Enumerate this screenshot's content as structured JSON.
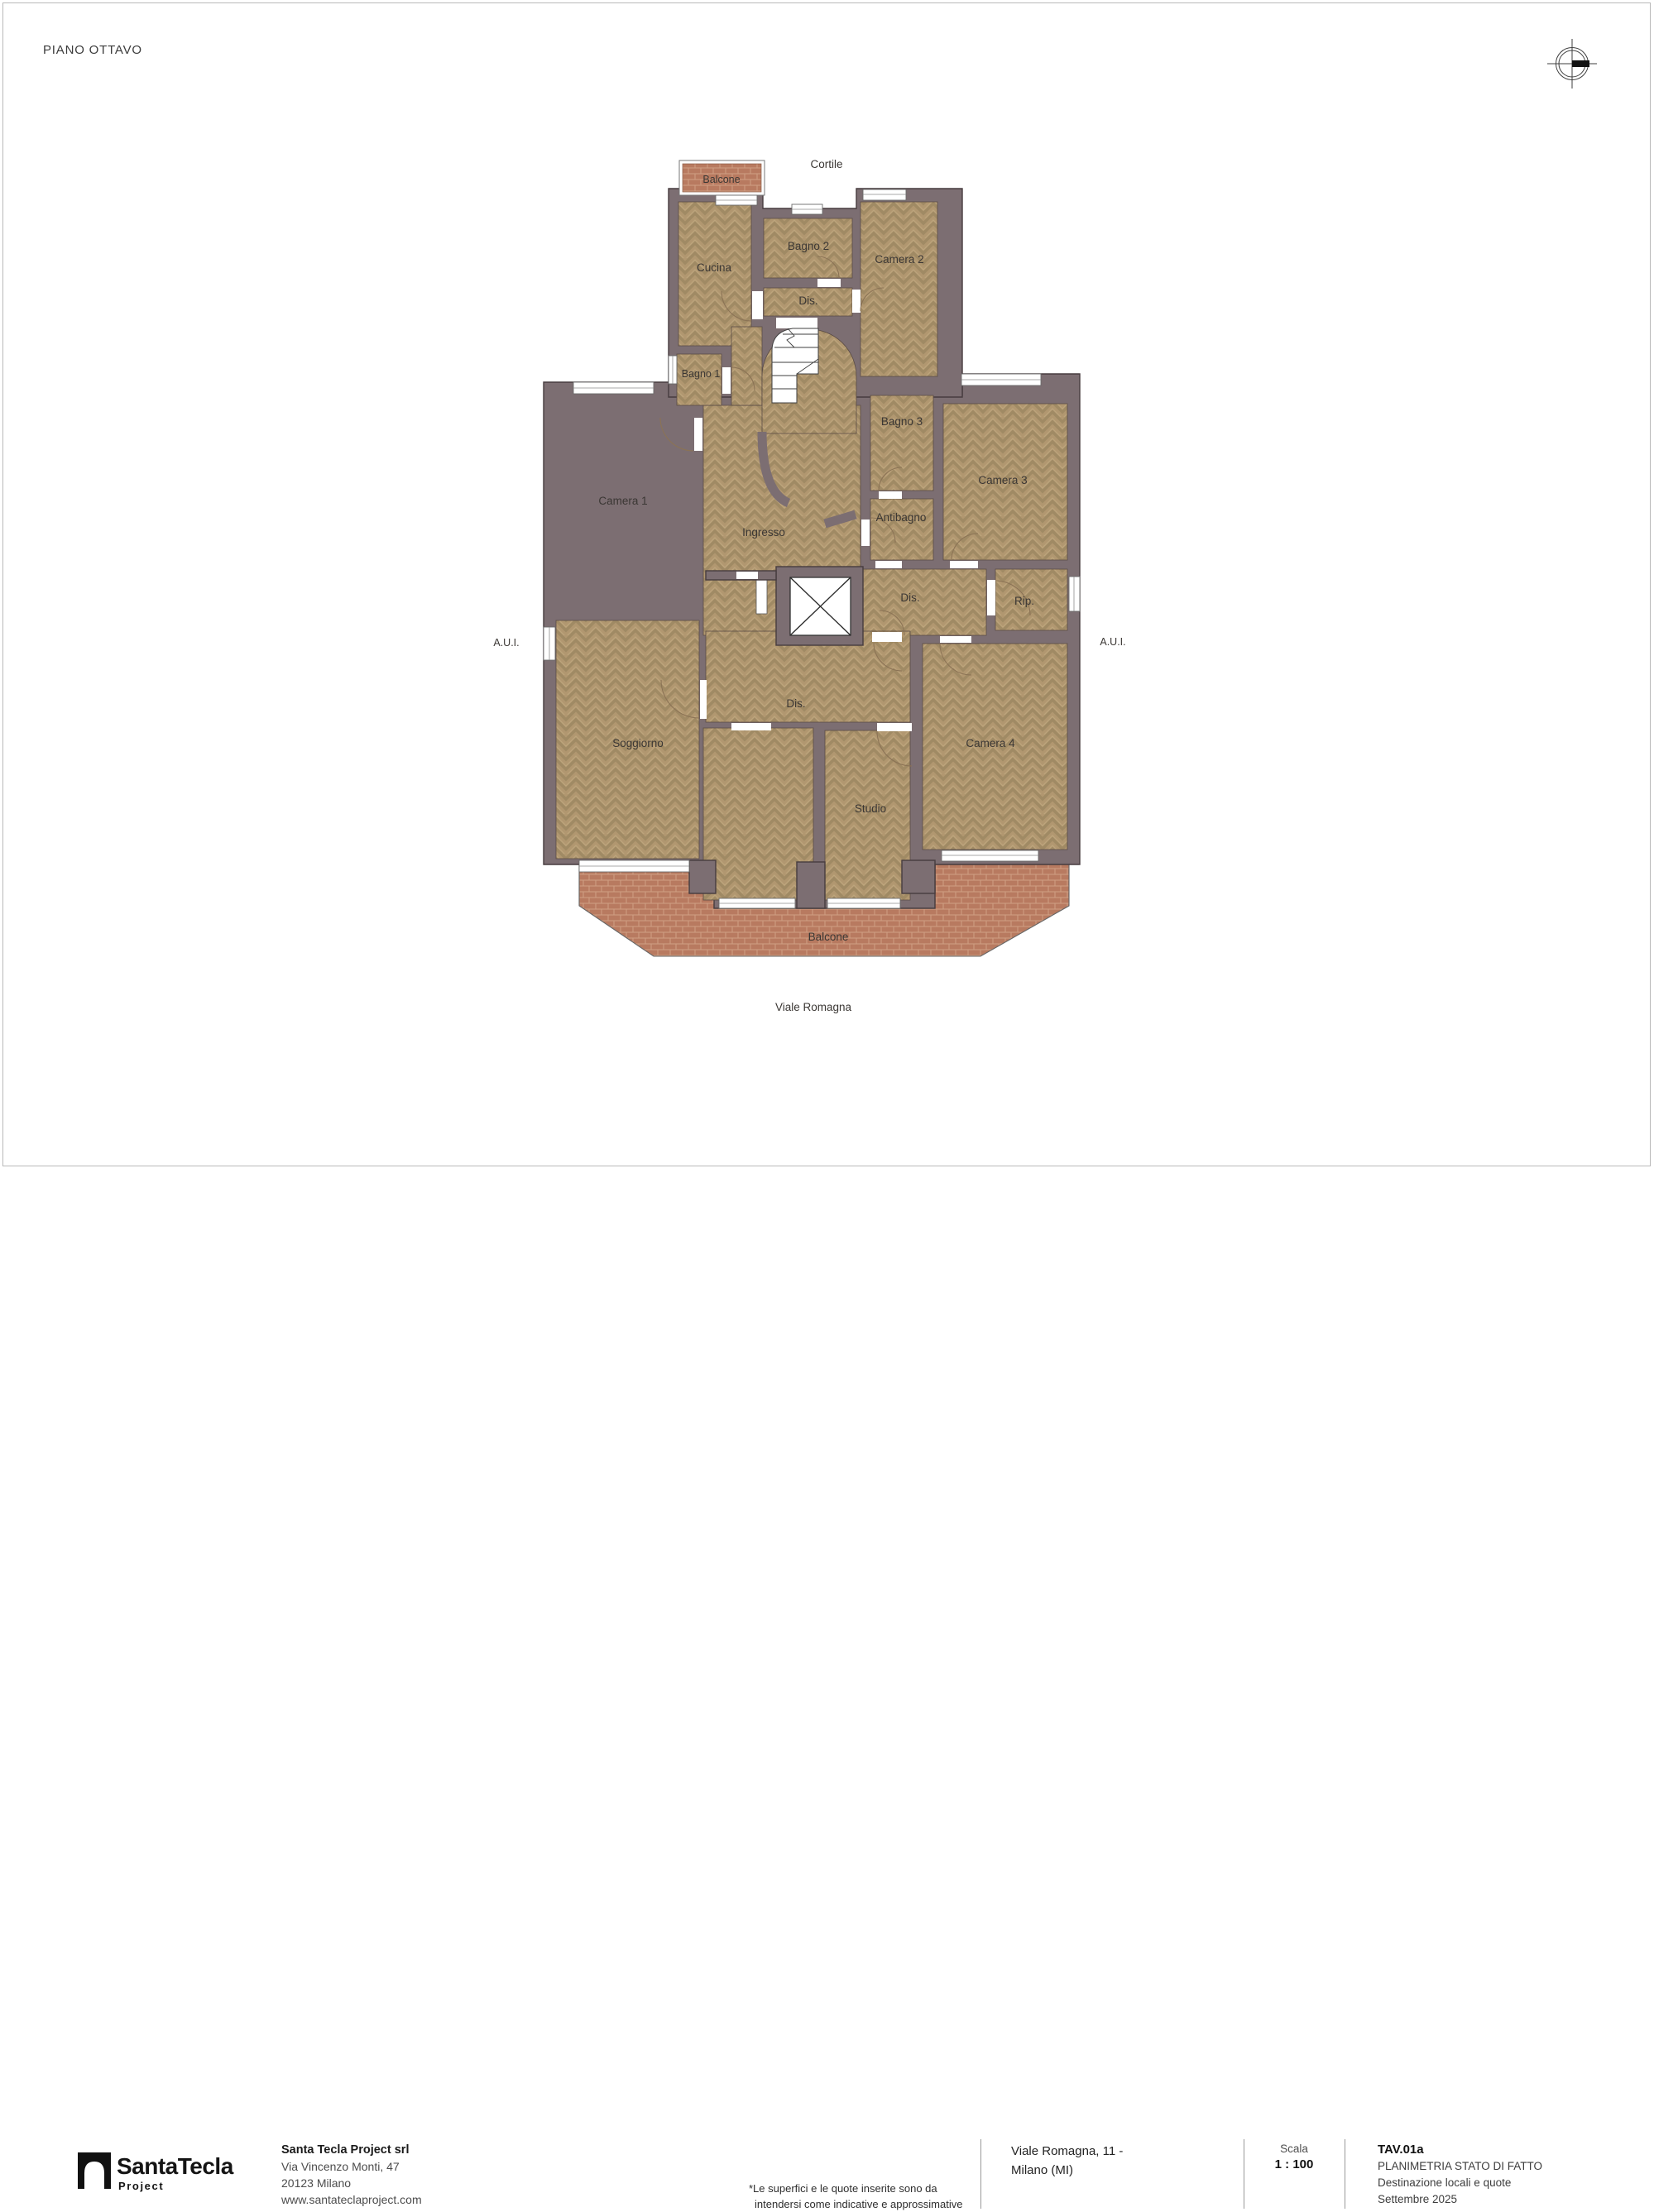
{
  "header": {
    "floor_title": "PIANO OTTAVO"
  },
  "plan": {
    "courtyard_label": "Cortile",
    "street_label": "Viale Romagna",
    "aui_left_label": "A.U.I.",
    "aui_right_label": "A.U.I.",
    "balcony_top_label": "Balcone",
    "balcony_bottom_label": "Balcone",
    "rooms": {
      "cucina": "Cucina",
      "bagno1": "Bagno 1",
      "bagno2": "Bagno 2",
      "bagno3": "Bagno 3",
      "camera1": "Camera 1",
      "camera2": "Camera 2",
      "camera3": "Camera 3",
      "camera4": "Camera 4",
      "dis_top": "Dis.",
      "dis_mid": "Dis.",
      "dis_low": "Dis.",
      "ingresso": "Ingresso",
      "antibagno": "Antibagno",
      "rip": "Rip.",
      "soggiorno": "Soggiorno",
      "studio": "Studio"
    }
  },
  "title_block": {
    "logo": {
      "brand": "SantaTecla",
      "brand_sub": "Project"
    },
    "company": {
      "name": "Santa Tecla Project srl",
      "address_line1": "Via Vincenzo Monti, 47",
      "address_line2": "20123 Milano",
      "website": "www.santateclaproject.com"
    },
    "disclaimer": {
      "line1": "*Le superfici e le quote inserite sono da",
      "line2": "intendersi come indicative e approssimative"
    },
    "site": {
      "line1": "Viale Romagna, 11 -",
      "line2": "Milano (MI)"
    },
    "scale": {
      "label": "Scala",
      "value": "1 : 100"
    },
    "sheet": {
      "code": "TAV.01a",
      "title": "PLANIMETRIA STATO DI FATTO",
      "subtitle": "Destinazione locali e quote",
      "date": "Settembre 2025"
    }
  },
  "colors": {
    "wall": "#7c6e72",
    "floor": "#b19770",
    "brick": "#b87a60",
    "text": "#3b3734"
  }
}
